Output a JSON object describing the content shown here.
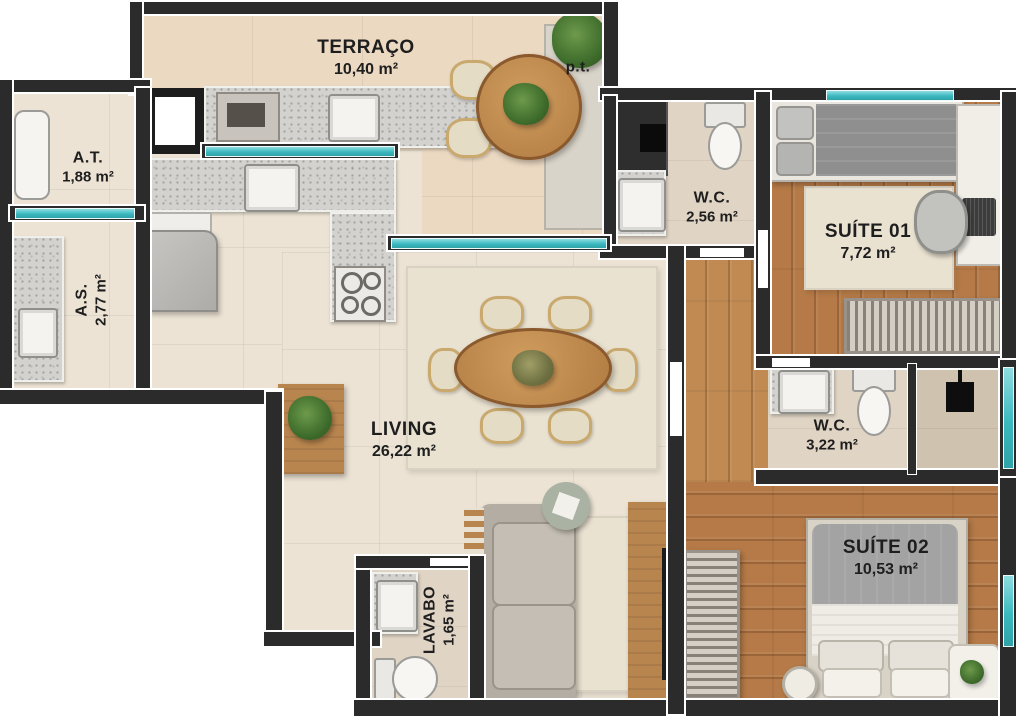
{
  "plan_title": "Apartment floor plan",
  "colors": {
    "wall": "#2b2b2b",
    "liner": "#ffffff",
    "window": "#3ab9bf",
    "tile": "#ece3d4",
    "terr": "#ecd9c2",
    "wood": "#b57a47",
    "wood2": "#c18a52",
    "granite": "#d3d2cf",
    "bath": "#e0d4c4",
    "rug": "#eae2d1",
    "furnwood": "#b8854e",
    "sofa": "#b3ada4",
    "fixture": "#f5f4f1",
    "label": "#1e1e1e",
    "shaft": "#2e2e2e"
  },
  "rooms": [
    {
      "key": "terraco",
      "name": "TERRAÇO",
      "area": "10,40 m²"
    },
    {
      "key": "at",
      "name": "A.T.",
      "area": "1,88 m²"
    },
    {
      "key": "as",
      "name": "A.S.",
      "area": "2,77 m²"
    },
    {
      "key": "wc_social",
      "name": "W.C.",
      "area": "2,56 m²"
    },
    {
      "key": "suite01",
      "name": "SUÍTE 01",
      "area": "7,72 m²"
    },
    {
      "key": "wc_suite",
      "name": "W.C.",
      "area": "3,22 m²"
    },
    {
      "key": "suite02",
      "name": "SUÍTE 02",
      "area": "10,53 m²"
    },
    {
      "key": "living",
      "name": "LIVING",
      "area": "26,22 m²"
    },
    {
      "key": "lavabo",
      "name": "LAVABO",
      "area": "1,65 m²"
    }
  ],
  "annotations": [
    {
      "key": "pt",
      "label": "p.t."
    }
  ]
}
